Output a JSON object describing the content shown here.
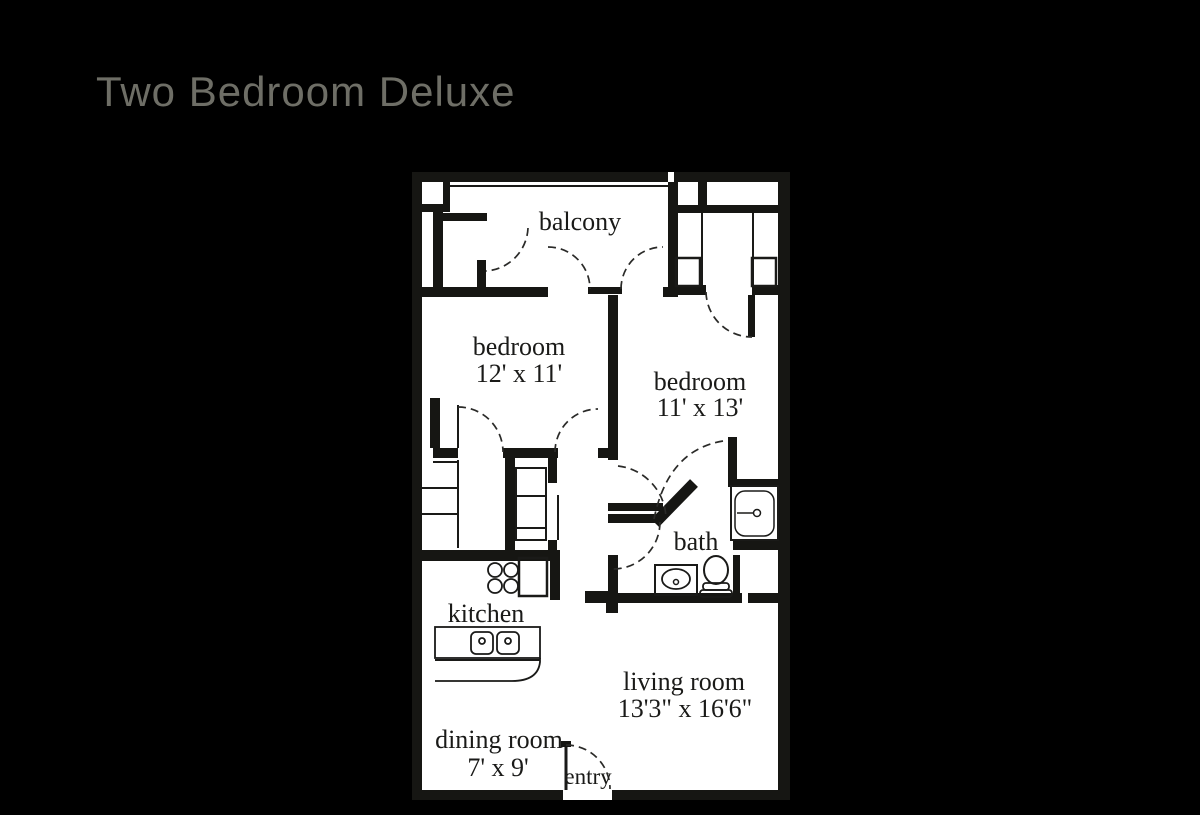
{
  "title": {
    "text": "Two Bedroom Deluxe",
    "color": "#6e6e66"
  },
  "floor_plan": {
    "wall_color": "#161613",
    "floor_color": "#ffffff",
    "dash_color": "#2a2a28",
    "labels": {
      "balcony": "balcony",
      "bedroom1": "bedroom",
      "bedroom1_dims": "12' x 11'",
      "bedroom2": "bedroom",
      "bedroom2_dims": "11' x 13'",
      "bath": "bath",
      "kitchen": "kitchen",
      "living_room": "living room",
      "living_room_dims": "13'3\" x 16'6\"",
      "dining_room": "dining room",
      "dining_room_dims": "7' x 9'",
      "entry": "entry"
    }
  }
}
